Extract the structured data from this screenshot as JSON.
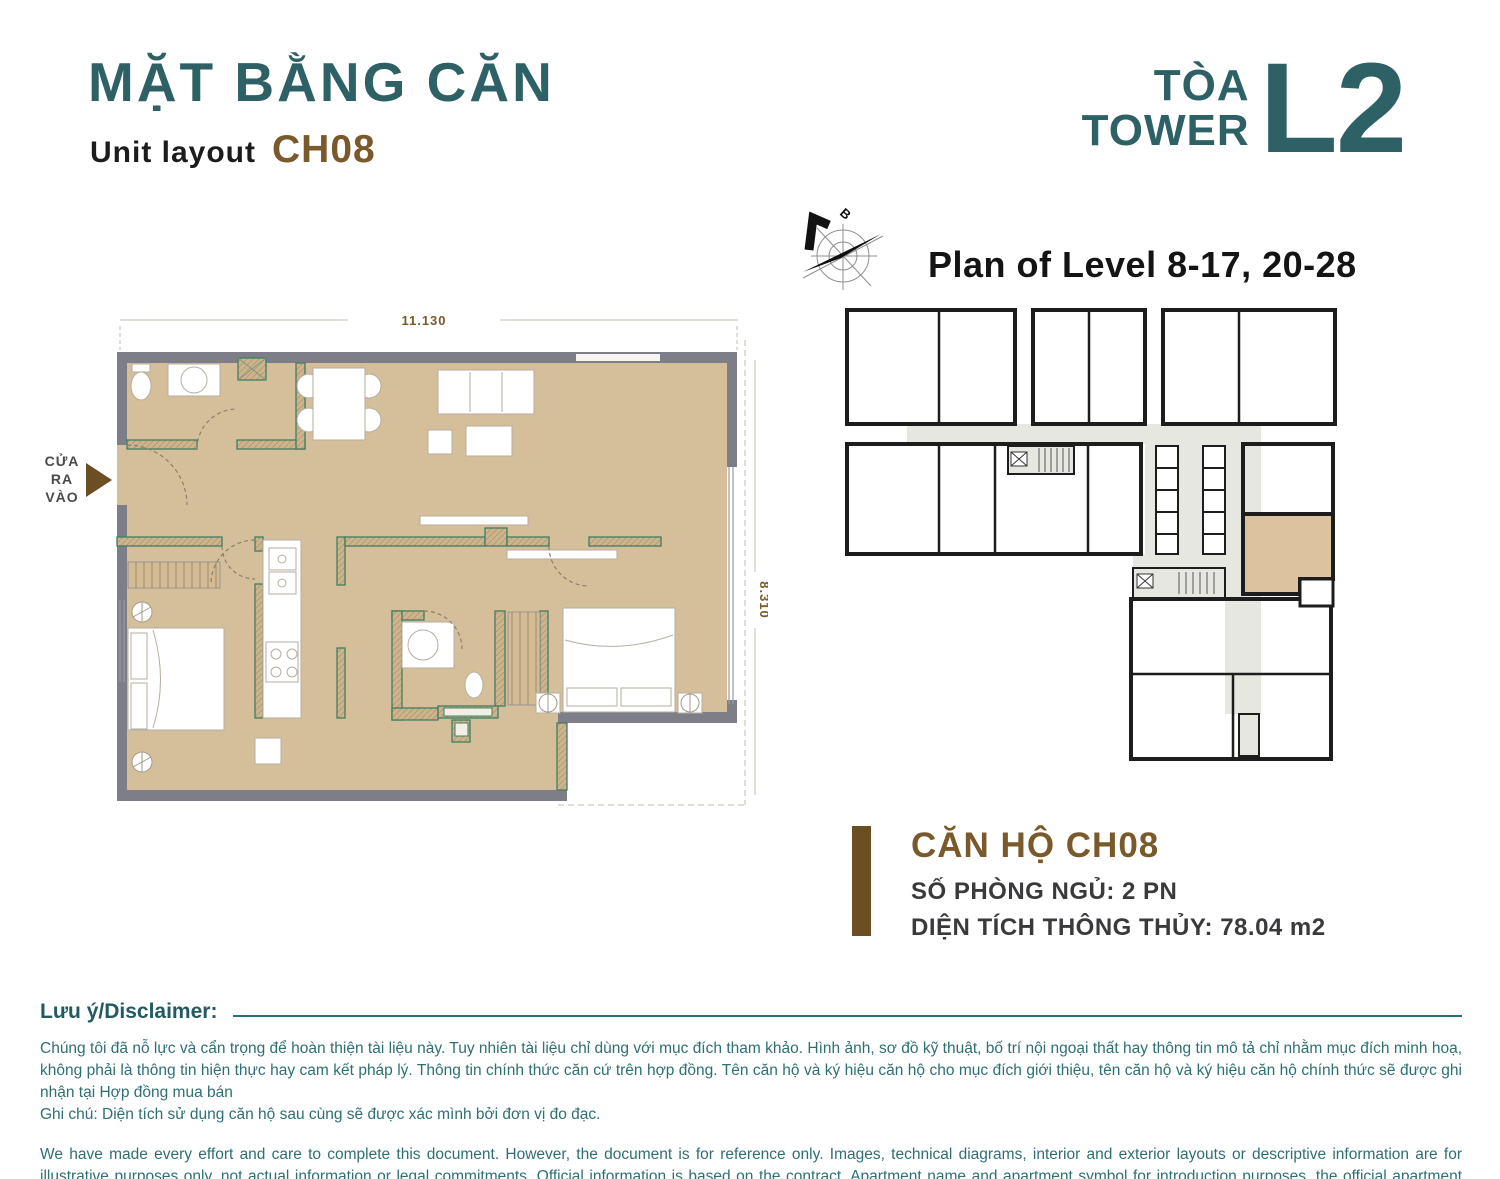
{
  "header": {
    "title_vi": "MẶT BẰNG CĂN",
    "subtitle_label": "Unit layout",
    "unit_code": "CH08",
    "tower_label_vi": "TÒA",
    "tower_label_en": "TOWER",
    "tower_code": "L2",
    "plan_level": "Plan of Level 8-17, 20-28"
  },
  "unit_plan": {
    "dim_width": "11.130",
    "dim_height": "8.310",
    "entrance_label": "CỬA\nRA\nVÀO",
    "compass_label": "B"
  },
  "unit_info": {
    "title": "CĂN HỘ CH08",
    "bedrooms": "SỐ PHÒNG NGỦ: 2 PN",
    "area": "DIỆN TÍCH THÔNG THỦY: 78.04 m2"
  },
  "disclaimer": {
    "heading": "Lưu ý/Disclaimer:",
    "vi_paragraph": "Chúng tôi đã nỗ lực và cẩn trọng để hoàn thiện tài liệu này. Tuy nhiên tài liệu chỉ dùng với mục đích tham khảo. Hình ảnh, sơ đồ kỹ thuật, bố trí nội ngoại thất hay thông tin mô tả chỉ nhằm mục đích minh hoạ, không phải là thông tin hiện thực hay cam kết pháp lý. Thông tin chính thức căn cứ trên hợp đồng. Tên căn hộ và ký hiệu căn hộ cho mục đích giới thiệu, tên căn hộ và ký hiệu căn hộ chính thức sẽ được ghi nhận tại Hợp đồng mua bán",
    "vi_note": "Ghi chú: Diện tích sử dụng căn hộ sau cùng sẽ được xác mình bởi đơn vị đo đạc.",
    "en_paragraph": "We have made every effort and care to complete this document. However, the document is for reference only. Images, technical diagrams, interior and exterior layouts or descriptive information are for illustrative purposes only, not actual information or legal commitments. Official information is based on the contract. Apartment name and apartment symbol for introduction purposes, the official apartment name and apartment symbol will be recorded in the Sales Purchase Agreement",
    "en_note": "Note: The final usable area of the apartment will be verified by the measuring unit."
  },
  "colors": {
    "teal": "#2d6165",
    "brown": "#7a5a2a",
    "floor_tan": "#d5bf9b",
    "wall_gray": "#7e7e88",
    "partition_teal": "#3f7d63",
    "corridor_gray": "#e7e7e2",
    "highlight_tan": "#dcc29e",
    "disclaimer_teal": "#2e6f74"
  }
}
